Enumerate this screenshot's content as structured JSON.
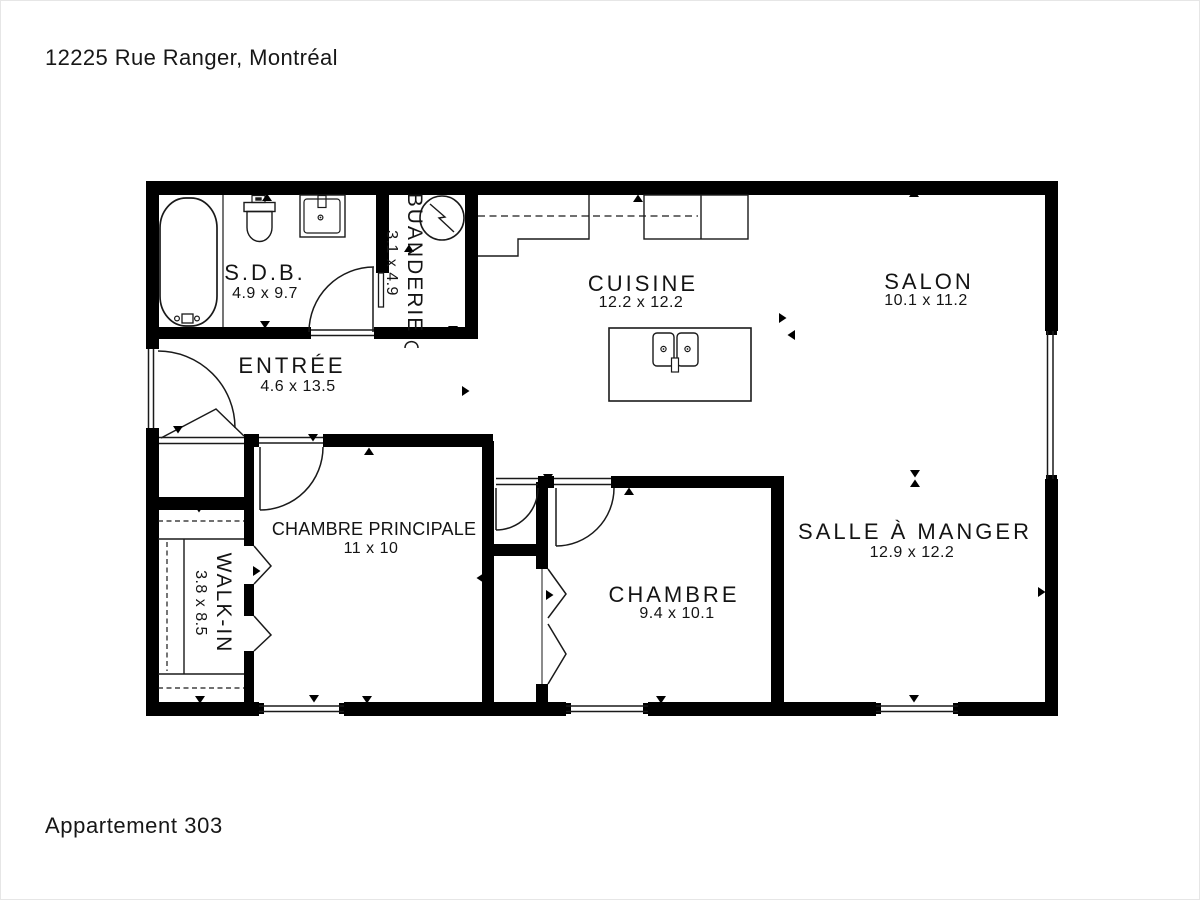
{
  "header": {
    "address": "12225 Rue Ranger, Montréal"
  },
  "footer": {
    "unit": "Appartement 303"
  },
  "colors": {
    "wall": "#000000",
    "line": "#1a1a1a",
    "background": "#ffffff",
    "text": "#141414"
  },
  "floorplan": {
    "rooms": [
      {
        "id": "sdb",
        "name": "S.D.B.",
        "dims": "4.9 x 9.7"
      },
      {
        "id": "buanderie",
        "name": "BUANDERIE",
        "dims": "3.1 x 4.9"
      },
      {
        "id": "cuisine",
        "name": "CUISINE",
        "dims": "12.2 x 12.2"
      },
      {
        "id": "salon",
        "name": "SALON",
        "dims": "10.1 x 11.2"
      },
      {
        "id": "entree",
        "name": "ENTRÉE",
        "dims": "4.6 x 13.5"
      },
      {
        "id": "chambre-principale",
        "name": "CHAMBRE PRINCIPALE",
        "dims": "11 x 10"
      },
      {
        "id": "walk-in",
        "name": "WALK-IN",
        "dims": "3.8 x 8.5"
      },
      {
        "id": "chambre",
        "name": "CHAMBRE",
        "dims": "9.4 x 10.1"
      },
      {
        "id": "salle-a-manger",
        "name": "SALLE À MANGER",
        "dims": "12.9 x 12.2"
      }
    ],
    "fixtures": [
      "bathtub-icon",
      "toilet-icon",
      "vanity-sink-icon",
      "washer-icon",
      "kitchen-island-sink-icon"
    ]
  }
}
